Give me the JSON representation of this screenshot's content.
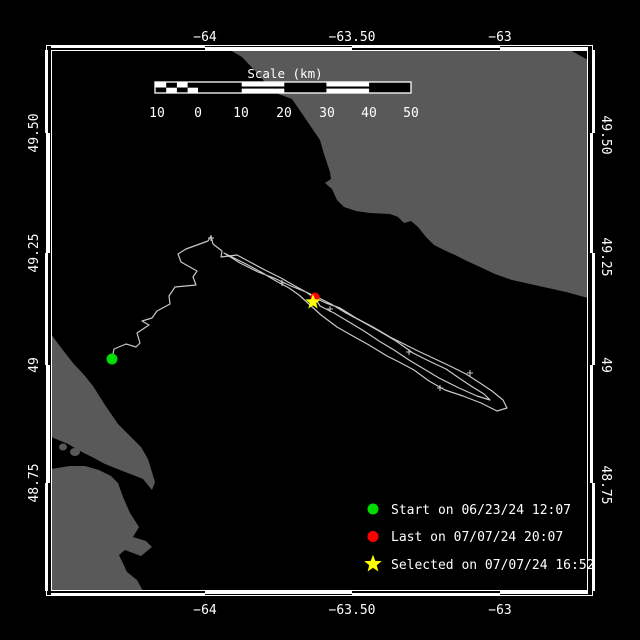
{
  "colors": {
    "background": "#000000",
    "land": "#595959",
    "frame": "#ffffff",
    "track": "#c8c8c8",
    "text": "#ffffff",
    "start_marker": "#00dc00",
    "last_marker": "#ff0000",
    "selected_marker": "#ffff00"
  },
  "axes": {
    "top": [
      {
        "label": "−64"
      },
      {
        "label": "−63.50"
      },
      {
        "label": "−63"
      }
    ],
    "bottom": [
      {
        "label": "−64"
      },
      {
        "label": "−63.50"
      },
      {
        "label": "−63"
      }
    ],
    "left": [
      {
        "label": "49.50"
      },
      {
        "label": "49.25"
      },
      {
        "label": "49"
      },
      {
        "label": "48.75"
      }
    ],
    "right": [
      {
        "label": "49.50"
      },
      {
        "label": "49.25"
      },
      {
        "label": "49"
      },
      {
        "label": "48.75"
      }
    ]
  },
  "scale_bar": {
    "title": "Scale (km)",
    "labels": [
      "10",
      "0",
      "10",
      "20",
      "30",
      "40",
      "50"
    ]
  },
  "legend": [
    {
      "marker": "start-dot",
      "label": "Start on 06/23/24 12:07"
    },
    {
      "marker": "last-dot",
      "label": "Last on 07/07/24 20:07"
    },
    {
      "marker": "selected-star",
      "label": "Selected on 07/07/24 16:52"
    }
  ],
  "map": {
    "markers": {
      "start": {
        "x": 112,
        "y": 359
      },
      "last": {
        "x": 315,
        "y": 297
      },
      "selected": {
        "x": 313,
        "y": 302
      }
    },
    "track_points": [
      [
        112,
        359
      ],
      [
        114,
        349
      ],
      [
        126,
        344
      ],
      [
        136,
        347
      ],
      [
        140,
        343
      ],
      [
        137,
        333
      ],
      [
        149,
        325
      ],
      [
        142,
        321
      ],
      [
        152,
        318
      ],
      [
        157,
        311
      ],
      [
        170,
        304
      ],
      [
        169,
        296
      ],
      [
        175,
        287
      ],
      [
        196,
        285
      ],
      [
        193,
        277
      ],
      [
        197,
        271
      ],
      [
        181,
        262
      ],
      [
        178,
        254
      ],
      [
        186,
        249
      ],
      [
        208,
        241
      ],
      [
        211,
        236
      ],
      [
        213,
        244
      ],
      [
        222,
        251
      ],
      [
        221,
        257
      ],
      [
        237,
        255
      ],
      [
        250,
        262
      ],
      [
        265,
        270
      ],
      [
        281,
        278
      ],
      [
        295,
        286
      ],
      [
        306,
        292
      ],
      [
        313,
        297
      ],
      [
        326,
        303
      ],
      [
        340,
        308
      ],
      [
        356,
        318
      ],
      [
        373,
        327
      ],
      [
        390,
        337
      ],
      [
        404,
        344
      ],
      [
        418,
        351
      ],
      [
        433,
        358
      ],
      [
        450,
        366
      ],
      [
        466,
        374
      ],
      [
        480,
        383
      ],
      [
        492,
        391
      ],
      [
        503,
        400
      ],
      [
        507,
        408
      ],
      [
        497,
        411
      ],
      [
        481,
        403
      ],
      [
        463,
        396
      ],
      [
        445,
        390
      ],
      [
        429,
        381
      ],
      [
        414,
        370
      ],
      [
        399,
        362
      ],
      [
        387,
        356
      ],
      [
        369,
        345
      ],
      [
        351,
        335
      ],
      [
        337,
        327
      ],
      [
        321,
        315
      ],
      [
        309,
        304
      ],
      [
        299,
        295
      ],
      [
        289,
        288
      ],
      [
        276,
        281
      ],
      [
        261,
        272
      ],
      [
        246,
        264
      ],
      [
        234,
        258
      ],
      [
        224,
        253
      ],
      [
        240,
        263
      ],
      [
        258,
        272
      ],
      [
        274,
        278
      ],
      [
        291,
        286
      ],
      [
        306,
        292
      ],
      [
        319,
        298
      ],
      [
        331,
        304
      ],
      [
        346,
        313
      ],
      [
        361,
        321
      ],
      [
        379,
        331
      ],
      [
        396,
        341
      ],
      [
        413,
        353
      ],
      [
        429,
        361
      ],
      [
        446,
        369
      ],
      [
        459,
        378
      ],
      [
        471,
        386
      ],
      [
        484,
        394
      ],
      [
        490,
        400
      ],
      [
        477,
        396
      ],
      [
        459,
        388
      ],
      [
        439,
        378
      ],
      [
        424,
        369
      ],
      [
        409,
        360
      ],
      [
        394,
        350
      ],
      [
        379,
        341
      ],
      [
        364,
        331
      ],
      [
        349,
        322
      ],
      [
        334,
        313
      ],
      [
        320,
        306
      ],
      [
        315,
        298
      ]
    ],
    "tick_marks": [
      [
        211,
        238
      ],
      [
        282,
        283
      ],
      [
        330,
        309
      ],
      [
        409,
        352
      ],
      [
        440,
        388
      ],
      [
        470,
        373
      ]
    ]
  }
}
